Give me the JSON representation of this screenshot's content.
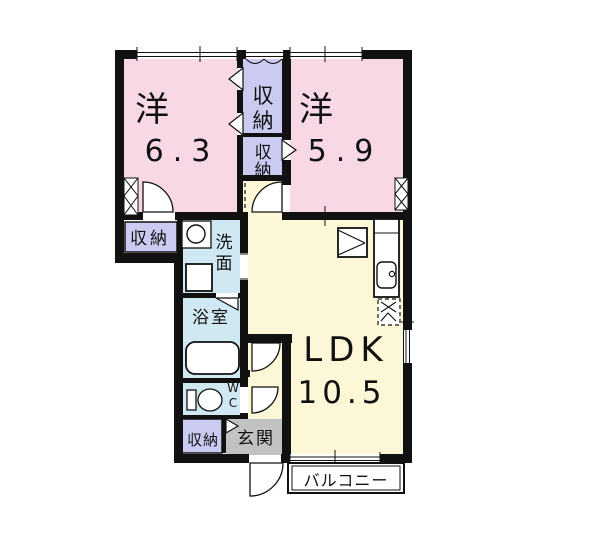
{
  "colors": {
    "bedroom": "#f8d8e5",
    "closet": "#cbcbf2",
    "wet": "#cfe8f2",
    "ldk": "#fcf7d6",
    "entry": "#c2c2c2",
    "wall": "#111111"
  },
  "labels": {
    "bedroom1_type": "洋",
    "bedroom1_size": "6.3",
    "bedroom2_type": "洋",
    "bedroom2_size": "5.9",
    "closet_top": "収納",
    "closet_mid": "収納",
    "closet_left": "収納",
    "closet_entry": "収納",
    "washroom": "洗面",
    "bathroom": "浴室",
    "wc": "WC",
    "ldk": "LDK",
    "ldk_size": "10.5",
    "entry": "玄関",
    "balcony": "バルコニー"
  }
}
